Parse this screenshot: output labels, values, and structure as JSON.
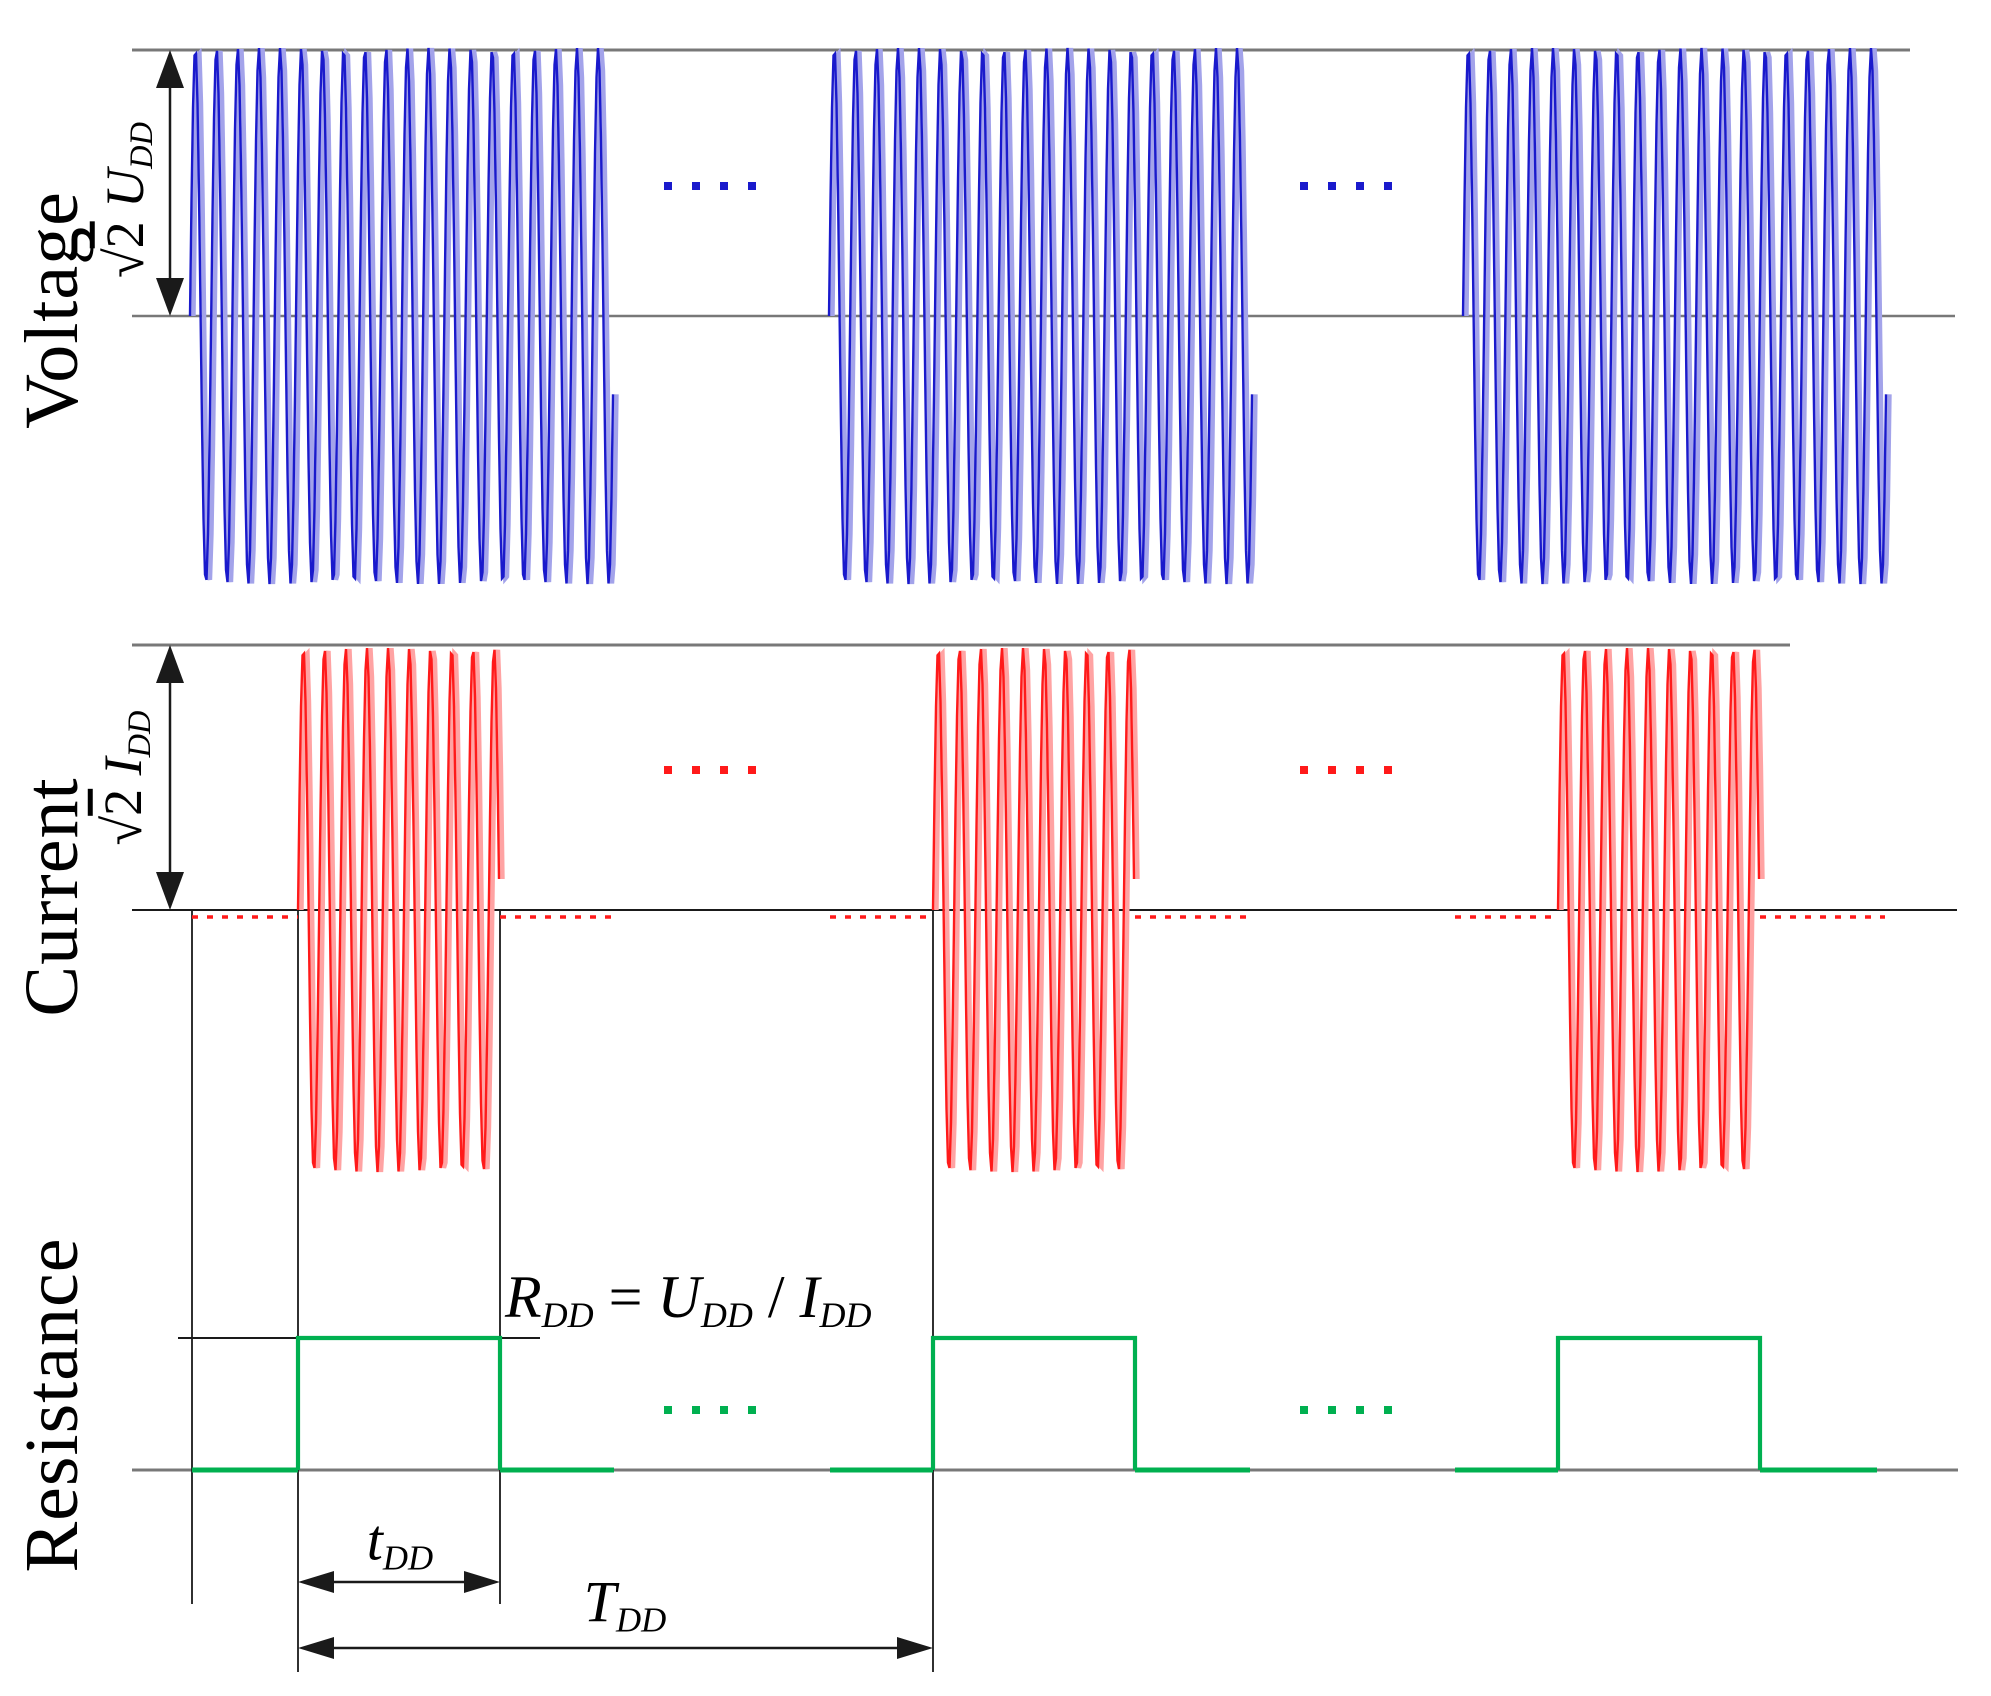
{
  "labels": {
    "voltage": "Voltage",
    "current": "Current",
    "resistance": "Resistance",
    "v_amp": [
      {
        "t": "√",
        "s": "plain"
      },
      {
        "t": "2",
        "s": "over"
      },
      {
        "t": " ",
        "s": "plain"
      },
      {
        "t": "U",
        "s": "it"
      },
      {
        "t": "DD",
        "s": "sub"
      }
    ],
    "i_amp": [
      {
        "t": "√",
        "s": "plain"
      },
      {
        "t": "2",
        "s": "over"
      },
      {
        "t": " ",
        "s": "plain"
      },
      {
        "t": "I",
        "s": "it"
      },
      {
        "t": "DD",
        "s": "sub"
      }
    ],
    "formula": [
      {
        "t": "R",
        "s": "it"
      },
      {
        "t": "DD",
        "s": "sub"
      },
      {
        "t": " = ",
        "s": "plain"
      },
      {
        "t": "U",
        "s": "it"
      },
      {
        "t": "DD",
        "s": "sub"
      },
      {
        "t": " / ",
        "s": "plain"
      },
      {
        "t": "I",
        "s": "it"
      },
      {
        "t": "DD",
        "s": "sub"
      }
    ],
    "t_dd": [
      {
        "t": "t",
        "s": "it"
      },
      {
        "t": "DD",
        "s": "sub"
      }
    ],
    "T_dd": [
      {
        "t": "T",
        "s": "it"
      },
      {
        "t": "DD",
        "s": "sub"
      }
    ]
  },
  "waveforms": {
    "width": 1991,
    "height": 1696,
    "colors": {
      "blue": "#1a1acc",
      "blue_ghost": "#a3a3ea",
      "red": "#ff1a1a",
      "red_ghost": "#ffa3a3",
      "green": "#00b050",
      "gray": "#787878",
      "black": "#1a1a1a"
    },
    "lines": [
      {
        "name": "voltage-peak-line",
        "x1": 132,
        "x2": 1910,
        "y": 50,
        "color": "gray",
        "w": 3
      },
      {
        "name": "voltage-zero-line",
        "x1": 132,
        "x2": 1955,
        "y": 316,
        "color": "gray",
        "w": 2.5
      },
      {
        "name": "current-peak-line",
        "x1": 132,
        "x2": 1790,
        "y": 645,
        "color": "gray",
        "w": 3
      },
      {
        "name": "current-zero-line",
        "x1": 132,
        "x2": 1957,
        "y": 910,
        "color": "black",
        "w": 2
      },
      {
        "name": "resistance-level-line",
        "x1": 178,
        "x2": 540,
        "y": 1338,
        "color": "black",
        "w": 2
      },
      {
        "name": "resistance-zero-line",
        "x1": 132,
        "x2": 1958,
        "y": 1470,
        "color": "gray",
        "w": 3
      }
    ],
    "vlines": [
      {
        "name": "marker-voltage-burst-start",
        "x": 192,
        "y1": 910,
        "y2": 1604
      },
      {
        "name": "marker-tdd-start",
        "x": 298,
        "y1": 910,
        "y2": 1672
      },
      {
        "name": "marker-tdd-end",
        "x": 500,
        "y1": 910,
        "y2": 1604
      },
      {
        "name": "marker-Tdd-end",
        "x": 933,
        "y1": 910,
        "y2": 1672
      }
    ],
    "varrows": [
      {
        "name": "voltage-amplitude-arrow",
        "x": 170,
        "y1": 50,
        "y2": 316
      },
      {
        "name": "current-amplitude-arrow",
        "x": 170,
        "y1": 645,
        "y2": 910
      }
    ],
    "harrows": [
      {
        "name": "tdd-dimension-arrow",
        "y": 1582,
        "x1": 298,
        "x2": 500
      },
      {
        "name": "Tdd-dimension-arrow",
        "y": 1648,
        "x1": 298,
        "x2": 933
      }
    ],
    "voltage": {
      "zero": 316,
      "amp": 268,
      "period": 21.2,
      "bursts": [
        [
          190,
          614
        ],
        [
          829,
          1253
        ],
        [
          1463,
          1887
        ]
      ],
      "dots": {
        "y": 186,
        "sets": [
          [
            668,
            752
          ],
          [
            1304,
            1388
          ]
        ]
      }
    },
    "current": {
      "zero": 910,
      "amp": 262,
      "period": 21.2,
      "bursts": [
        [
          298,
          500
        ],
        [
          933,
          1135
        ],
        [
          1558,
          1760
        ]
      ],
      "dashes": {
        "y": 917,
        "segs": [
          [
            192,
            298
          ],
          [
            500,
            614
          ],
          [
            830,
            933
          ],
          [
            1135,
            1250
          ],
          [
            1455,
            1558
          ],
          [
            1760,
            1885
          ]
        ]
      },
      "dots": {
        "y": 770,
        "sets": [
          [
            668,
            752
          ],
          [
            1304,
            1388
          ]
        ]
      }
    },
    "resistance": {
      "base": 1470,
      "top": 1338,
      "pulses": [
        [
          298,
          500
        ],
        [
          933,
          1135
        ],
        [
          1558,
          1760
        ]
      ],
      "base_segs": [
        [
          192,
          298
        ],
        [
          500,
          614
        ],
        [
          830,
          933
        ],
        [
          1135,
          1250
        ],
        [
          1455,
          1558
        ],
        [
          1760,
          1877
        ]
      ],
      "dots": {
        "y": 1410,
        "sets": [
          [
            668,
            752
          ],
          [
            1304,
            1388
          ]
        ]
      }
    }
  }
}
